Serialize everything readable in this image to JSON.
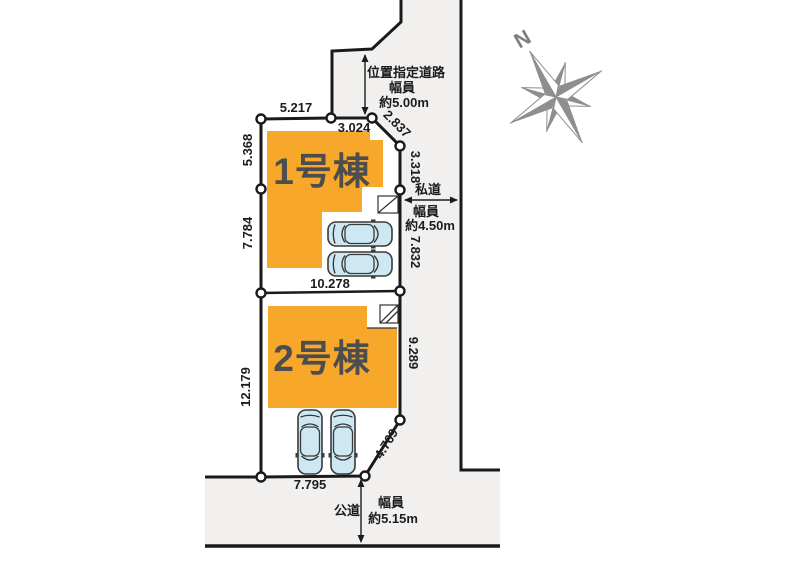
{
  "plan": {
    "buildings": [
      {
        "label": "1号棟"
      },
      {
        "label": "2号棟"
      }
    ],
    "roads": {
      "designated": {
        "name": "位置指定道路",
        "width_label": "幅員",
        "width": "約5.00m"
      },
      "private": {
        "name": "私道",
        "width_label": "幅員",
        "width": "約4.50m"
      },
      "public": {
        "name": "公道",
        "width_label": "幅員",
        "width": "約5.15m"
      }
    },
    "dimensions": {
      "plot1": {
        "top_left": "5.217",
        "top_right": "3.024",
        "diagonal": "2.837",
        "right_upper": "3.318",
        "left_upper": "5.368",
        "left_lower": "7.784",
        "right_lower": "7.832",
        "bottom": "10.278"
      },
      "plot2": {
        "left": "12.179",
        "right": "9.289",
        "diagonal": "4.769",
        "bottom": "7.795"
      }
    },
    "compass": {
      "label": "N"
    },
    "colors": {
      "building": "#F7A82A",
      "road": "#F1F0EF",
      "line": "#1A1A1A",
      "car": "#CDE8F2",
      "compass": "#8E8E8E"
    }
  }
}
